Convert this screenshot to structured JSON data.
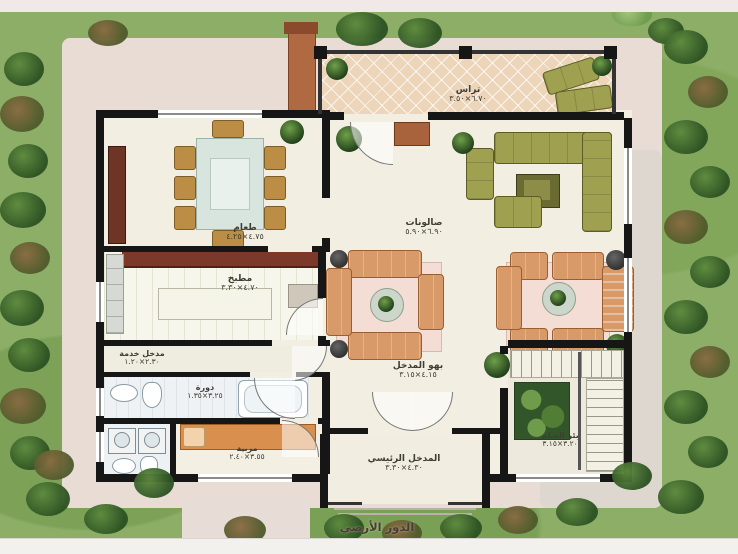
{
  "title": "الدور الأرضي",
  "rooms": {
    "dining": {
      "name": "طعام",
      "dims": "٤.٧٥×٤.٢٥"
    },
    "living": {
      "name": "صالونات",
      "dims": "٦.٩٠×٥.٩٠"
    },
    "kitchen": {
      "name": "مطبخ",
      "dims": "٤.٧٠×٣.٣٠"
    },
    "terrace": {
      "name": "تراس",
      "dims": "٦.٧٠×٣.٥٠"
    },
    "hall": {
      "name": "بهو المدخل",
      "dims": "٤.١٥×٣.١٥"
    },
    "entrance": {
      "name": "المدخل الرئيسي",
      "dims": "٤.٣٠×٣.٣٠"
    },
    "stair": {
      "name": "بئر السلم",
      "dims": "٣.٢٠×٣.١٥"
    },
    "maid": {
      "name": "مربية",
      "dims": "٣.٥٥×٢.٤٠"
    },
    "bath": {
      "name": "دورة",
      "dims": "٣.٢٥×١.٣٥"
    },
    "service": {
      "name": "مدخل خدمة",
      "dims": "٢.٣٠×١.٢٠"
    }
  },
  "colors": {
    "wall": "#161616",
    "grass": "#8cae66",
    "lot": "#e9dcd5",
    "floor": "#f2efe2",
    "terrace_tile": "#edd5ba",
    "sofa_orange": "#d99a6a",
    "sofa_olive": "#9fa050",
    "counter_red": "#7c392a"
  }
}
